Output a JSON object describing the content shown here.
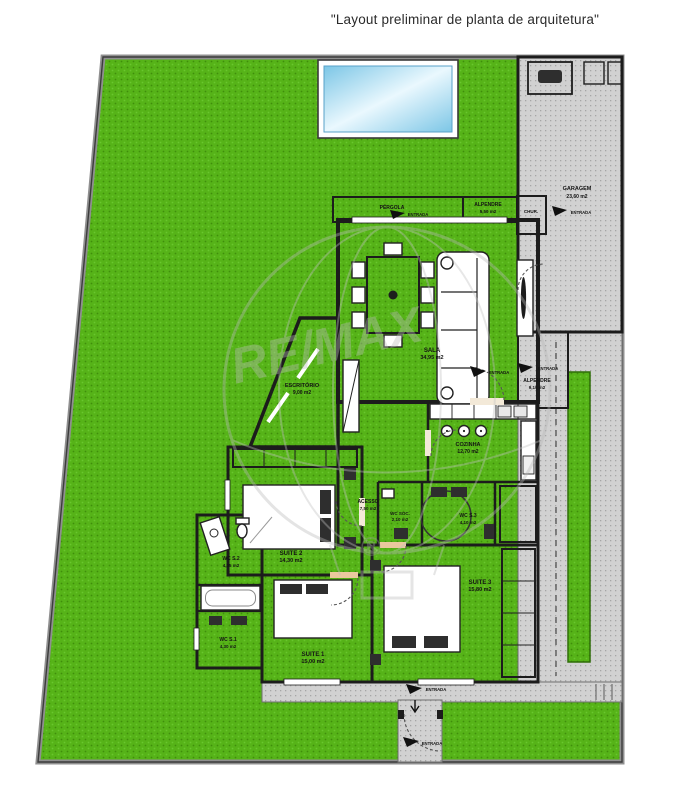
{
  "title": "\"Layout preliminar de planta de arquitetura\"",
  "watermark": {
    "brand": "RE/MAX",
    "registered": "®"
  },
  "colors": {
    "grass": "#56b318",
    "pavement": "#cfcfcf",
    "wood_floor": "#eac89e",
    "tile_floor": "#f3e9d8",
    "wall": "#1c1c1c",
    "pool_water": "#8fd2ee"
  },
  "rooms": {
    "sala": {
      "label": "SALA",
      "area": "34,95 m2"
    },
    "cozinha": {
      "label": "COZINHA",
      "area": "12,70 m2"
    },
    "escritorio": {
      "label": "ESCRITÓRIO",
      "area": "9,00 m2"
    },
    "acesso": {
      "label": "ACESSO",
      "area": "7,50 m2"
    },
    "wc_soc": {
      "label": "WC SOC.",
      "area": "2,10 m2"
    },
    "wc_s1": {
      "label": "WC S.1",
      "area": "4,30 m2"
    },
    "wc_s2": {
      "label": "WC S.2",
      "area": "4,05 m2"
    },
    "wc_s3": {
      "label": "WC S.3",
      "area": "4,10 m2"
    },
    "suite1": {
      "label": "SUITE 1",
      "area": "15,00 m2"
    },
    "suite2": {
      "label": "SUITE 2",
      "area": "14,30 m2"
    },
    "suite3": {
      "label": "SUITE 3",
      "area": "15,80 m2"
    },
    "alpendre_top": {
      "label": "ALPENDRE",
      "area": "5,50 m2"
    },
    "alpendre_right": {
      "label": "ALPENDRE",
      "area": "9,10 m2"
    },
    "garagem": {
      "label": "GARAGEM",
      "area": "23,60 m2"
    },
    "pergola": {
      "label": "PÉRGOLA"
    },
    "churrasqueira": {
      "label": "CHUR."
    }
  },
  "markers": {
    "entrance": "ENTRADA"
  }
}
